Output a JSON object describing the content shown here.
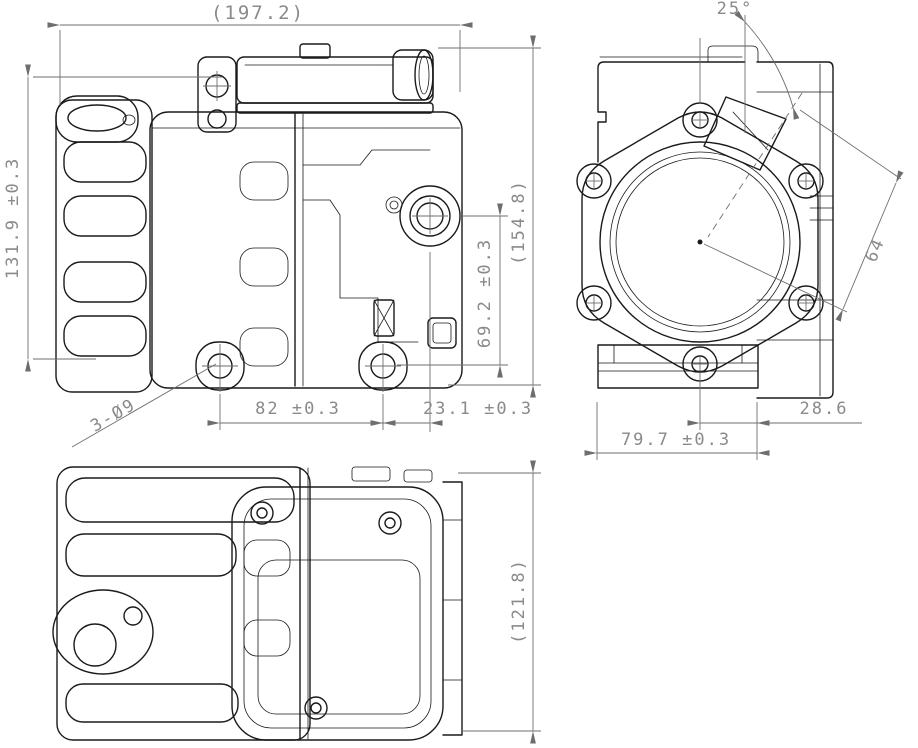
{
  "drawing": {
    "colors": {
      "background": "#ffffff",
      "part_line": "#1a1a1a",
      "dim_line": "#6e6e6e",
      "dim_text": "#8a8a8a"
    },
    "dims": {
      "overall_length": "(197.2)",
      "body_height": "131.9 ±0.3",
      "overall_height": "(154.8)",
      "port_height": "69.2 ±0.3",
      "holes_note": "3-Ø9",
      "mount_pitch": "82 ±0.3",
      "mount_to_port_axis": "23.1 ±0.3",
      "port_angle": "25°",
      "diagonal_offset": "64",
      "center_to_edge": "28.6",
      "foot_width": "79.7 ±0.3",
      "body_depth": "(121.8)"
    }
  }
}
